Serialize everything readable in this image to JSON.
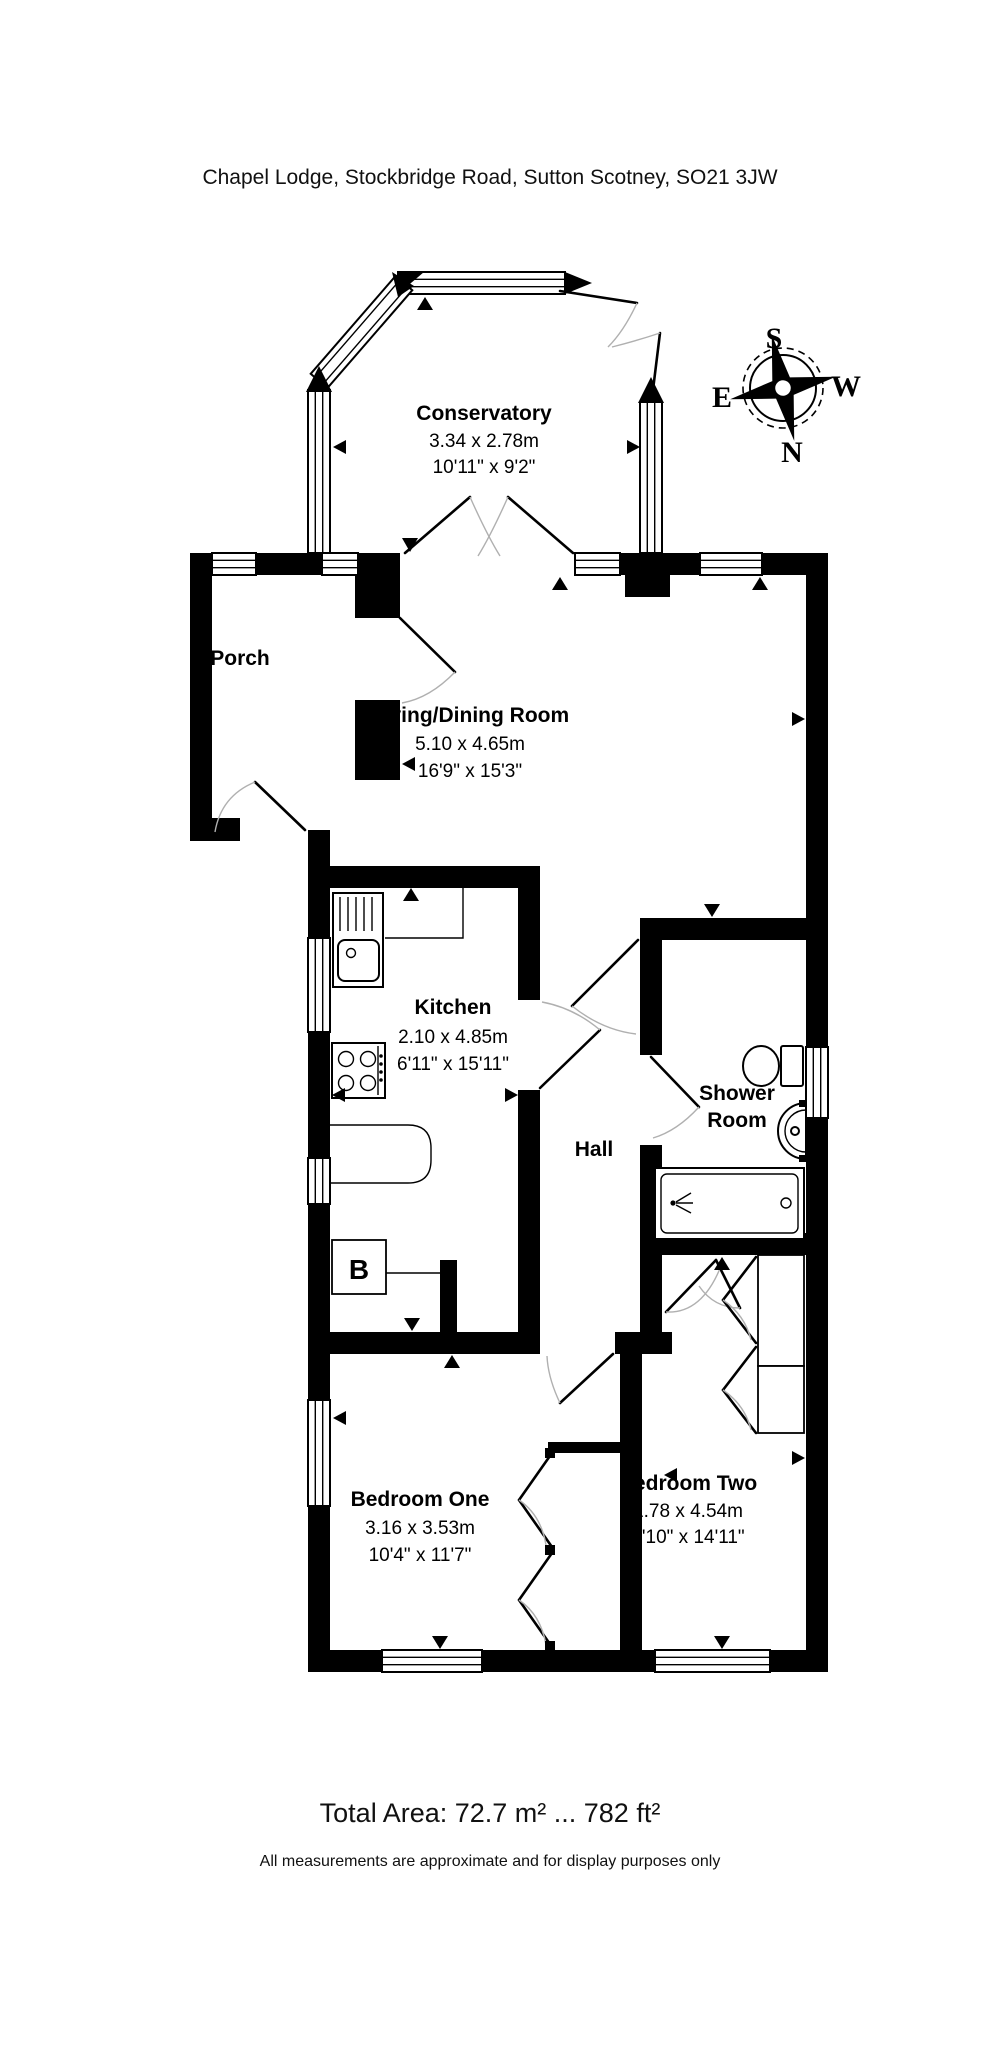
{
  "title": "Chapel Lodge, Stockbridge Road, Sutton Scotney, SO21 3JW",
  "compass": {
    "north": "N",
    "south": "S",
    "east": "E",
    "west": "W"
  },
  "rooms": {
    "conservatory": {
      "name": "Conservatory",
      "metric": "3.34 x 2.78m",
      "imperial": "10'11\" x 9'2\""
    },
    "porch": {
      "name": "Porch"
    },
    "living_dining": {
      "name": "Living/Dining Room",
      "metric": "5.10 x 4.65m",
      "imperial": "16'9\" x 15'3\""
    },
    "kitchen": {
      "name": "Kitchen",
      "metric": "2.10 x 4.85m",
      "imperial": "6'11\" x 15'11\""
    },
    "hall": {
      "name": "Hall"
    },
    "shower_room": {
      "lines": [
        "Shower",
        "Room"
      ]
    },
    "bedroom_one": {
      "name": "Bedroom One",
      "metric": "3.16 x 3.53m",
      "imperial": "10'4\" x 11'7\""
    },
    "bedroom_two": {
      "name": "Bedroom Two",
      "metric": "1.78 x 4.54m",
      "imperial": "5'10\" x 14'11\""
    }
  },
  "labels": {
    "boiler": "B"
  },
  "footer": {
    "total_area": "Total Area: 72.7 m² ... 782 ft²",
    "disclaimer": "All measurements are approximate and for display purposes only"
  },
  "colors": {
    "wall": "#000000",
    "background": "#ffffff",
    "door_arc": "#b0b0b0"
  }
}
